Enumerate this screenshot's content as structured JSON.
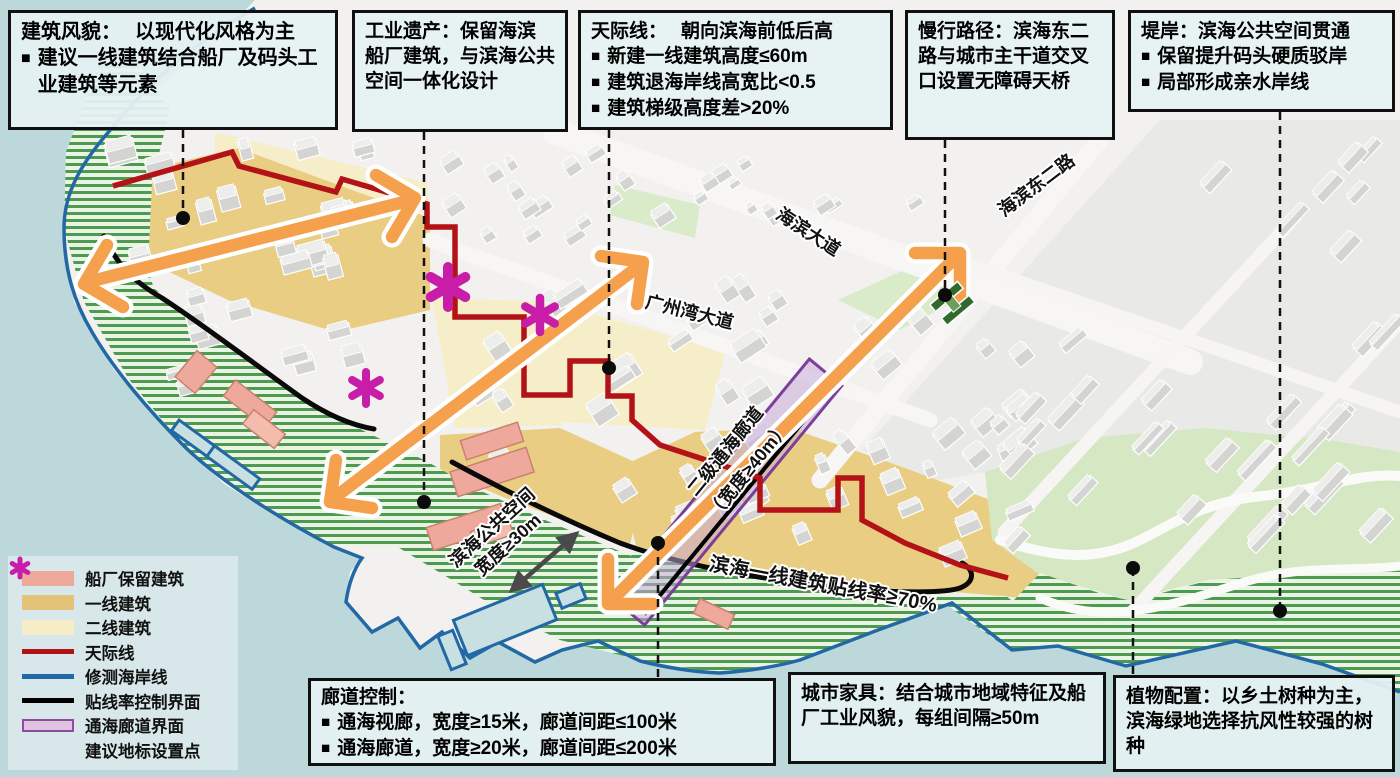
{
  "ui": {
    "bullet": "■"
  },
  "callouts": {
    "building_style": {
      "title": "建筑风貌：",
      "subtitle": "以现代化风格为主",
      "bullets": [
        "建议一线建筑结合船厂及码头工业建筑等元素"
      ]
    },
    "industrial_heritage": {
      "title": "工业遗产：",
      "body": "保留海滨船厂建筑，与滨海公共空间一体化设计"
    },
    "skyline": {
      "title": "天际线：",
      "subtitle": "朝向滨海前低后高",
      "bullets": [
        "新建一线建筑高度≤60m",
        "建筑退海岸线高宽比<0.5",
        "建筑梯级高度差>20%"
      ]
    },
    "slow_path": {
      "title": "慢行路径：",
      "body": "滨海东二路与城市主干道交叉口设置无障碍天桥"
    },
    "embankment": {
      "title": "堤岸：",
      "subtitle": "滨海公共空间贯通",
      "bullets": [
        "保留提升码头硬质驳岸",
        "局部形成亲水岸线"
      ]
    },
    "corridor_control": {
      "title": "廊道控制：",
      "bullets": [
        "通海视廊，宽度≥15米，廊道间距≤100米",
        "通海廊道，宽度≥20米，廊道间距≤200米"
      ]
    },
    "urban_furniture": {
      "title": "城市家具：",
      "body": "结合城市地域特征及船厂工业风貌，每组间隔≥50m"
    },
    "planting": {
      "title": "植物配置：",
      "body": "以乡土树种为主，滨海绿地选择抗风性较强的树种"
    }
  },
  "legend": {
    "items": [
      {
        "type": "fill",
        "color": "#EFA99C",
        "label": "船厂保留建筑"
      },
      {
        "type": "fill",
        "color": "#E3C377",
        "label": "一线建筑"
      },
      {
        "type": "fill",
        "color": "#F6EDC6",
        "label": "二线建筑"
      },
      {
        "type": "line",
        "color": "#B31217",
        "label": "天际线"
      },
      {
        "type": "line",
        "color": "#2268A5",
        "label": "修测海岸线"
      },
      {
        "type": "line",
        "color": "#000000",
        "label": "贴线率控制界面"
      },
      {
        "type": "outline",
        "color": "#DFC3E1",
        "border": "#8E4D9E",
        "label": "通海廊道界面"
      },
      {
        "type": "asterisk",
        "color": "#C71DA8",
        "label": "建议地标设置点"
      }
    ]
  },
  "map_labels": {
    "haibin_avenue": "海滨大道",
    "gzw_avenue": "广州湾大道",
    "haibin_east2": "海滨东二路",
    "corridor_line1": "二级通海廊道",
    "corridor_line2": "（宽度≥40m）",
    "public_space_line1": "滨海公共空间",
    "public_space_line2": "宽度≥30m",
    "setback": "滨海一线建筑贴线率≥70%"
  },
  "colors": {
    "sea": "#BCD8DB",
    "land": "#F2F1EF",
    "grid_block": "#E9E9E7",
    "gold_zone": "#E9CD82",
    "pale_zone": "#F6EEC9",
    "park": "#D5E8C3",
    "hatch_bg": "#EAF4E3",
    "hatch_line": "#4F9A52",
    "shipyard": "#EFA99C",
    "skyline_red": "#B31217",
    "coast_blue": "#2268A5",
    "corridor_purple": "#7C3F99",
    "arrow_orange": "#F5A04C",
    "landmark_magenta": "#C71DA8",
    "bridge_green": "#2E6B2C",
    "measure_gray": "#4A4A4A"
  }
}
